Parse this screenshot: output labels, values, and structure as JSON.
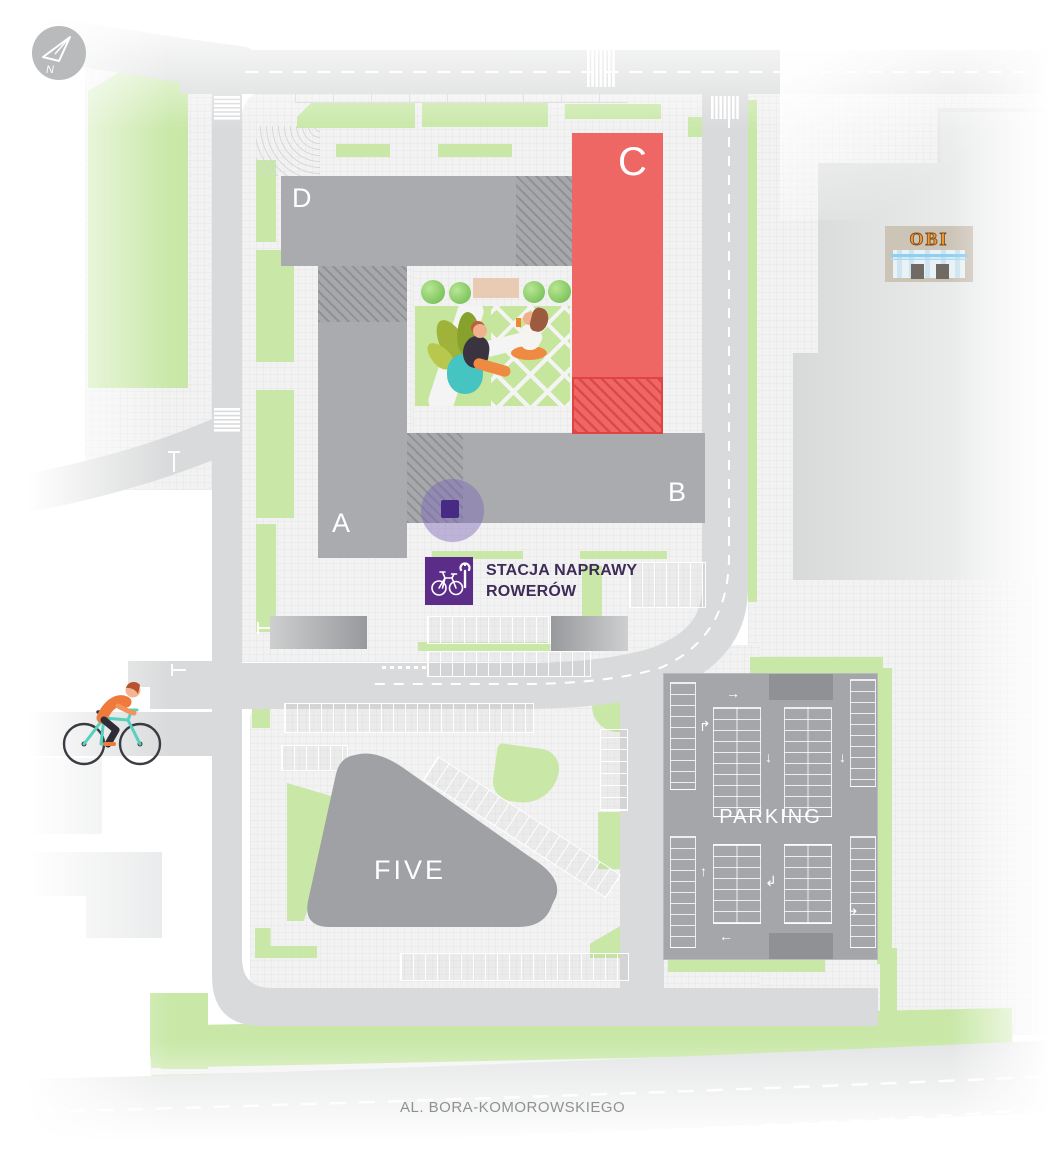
{
  "map": {
    "compass": {
      "label": "N"
    },
    "buildings": {
      "d": "D",
      "c": "C",
      "a": "A",
      "b": "B",
      "five": "FIVE"
    },
    "parking": {
      "label": "PARKING",
      "arrows": [
        "→",
        "↱",
        "↓",
        "↓",
        "↑",
        "↲",
        "↳",
        "←"
      ]
    },
    "bike_station": {
      "line1": "STACJA NAPRAWY",
      "line2": "ROWERÓW"
    },
    "obi": {
      "label": "OBI"
    },
    "street": {
      "label": "AL. BORA-KOMOROWSKIEGO"
    },
    "colors": {
      "building_gray": "#a9abae",
      "accent_red": "#ee6765",
      "green": "#c9e8a8",
      "road": "#d9dadb",
      "purple_marker": "#472a84",
      "purple_icon_bg": "#5b2d88",
      "purple_text": "#3e2b58",
      "obi_orange": "#f59b2d"
    }
  }
}
